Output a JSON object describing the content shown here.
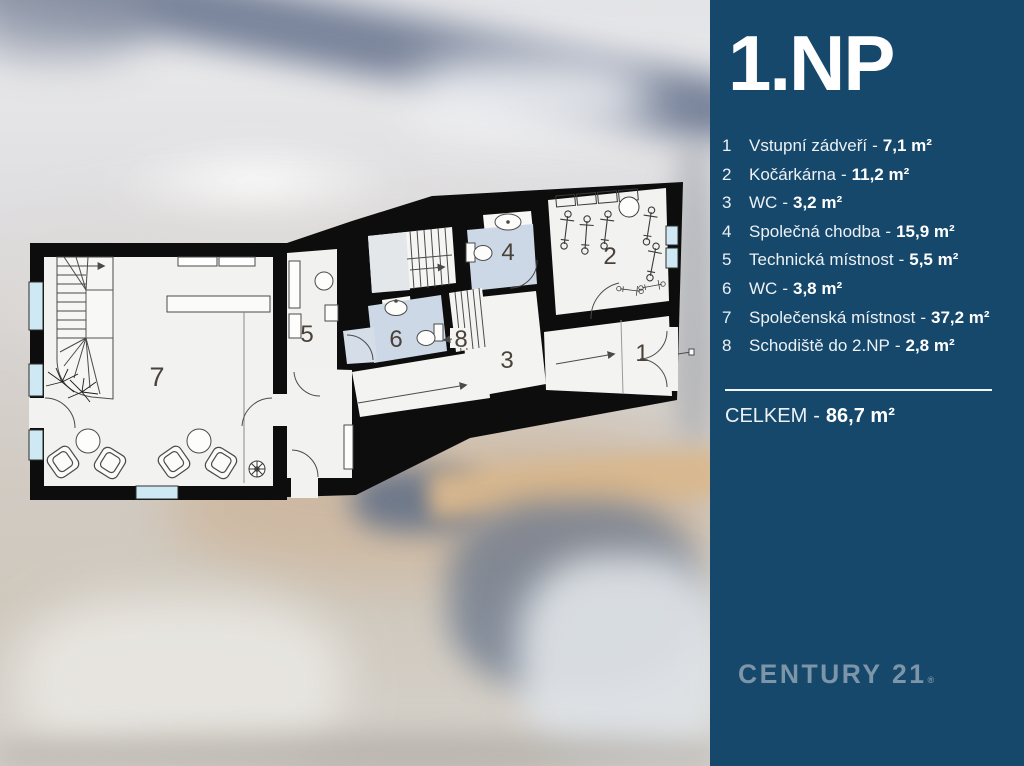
{
  "sidebar": {
    "bg_color": "#16486B",
    "title": "1.NP",
    "separator": "-",
    "items": [
      {
        "num": "1",
        "name": "Vstupní zádveří",
        "area": "7,1 m²"
      },
      {
        "num": "2",
        "name": "Kočárkárna",
        "area": "11,2 m²"
      },
      {
        "num": "3",
        "name": "WC",
        "area": "3,2 m²"
      },
      {
        "num": "4",
        "name": "Společná chodba",
        "area": "15,9 m²"
      },
      {
        "num": "5",
        "name": "Technická místnost",
        "area": "5,5 m²"
      },
      {
        "num": "6",
        "name": "WC",
        "area": "3,8 m²"
      },
      {
        "num": "7",
        "name": "Společenská místnost",
        "area": "37,2 m²"
      },
      {
        "num": "8",
        "name": "Schodiště do 2.NP",
        "area": "2,8 m²"
      }
    ],
    "total": {
      "label": "CELKEM",
      "area": "86,7 m²"
    },
    "brand": {
      "text": "CENTURY 21",
      "reg": "®",
      "color": "#7D95A8"
    }
  },
  "plan": {
    "wall_color": "#0d0d0d",
    "floor_color": "#f2f2f0",
    "wet_floor_color": "#ccd8e5",
    "glass_color": "#cfe9f4",
    "labels": {
      "r1": "1",
      "r2": "2",
      "r3": "3",
      "r4": "4",
      "r5": "5",
      "r6": "6",
      "r7": "7",
      "r8": "8"
    }
  }
}
